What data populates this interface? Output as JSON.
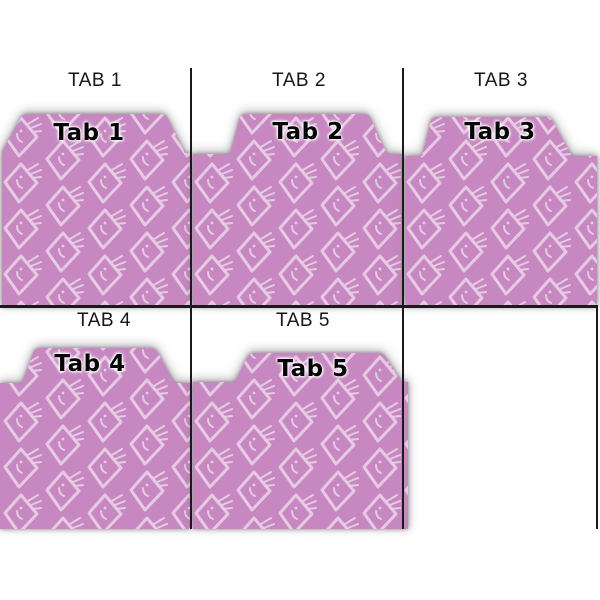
{
  "preview_title": "Tab divider preview sheet",
  "sections": [
    {
      "label": "TAB 1",
      "tab_text": "Tab 1",
      "tab_cut_position": "left"
    },
    {
      "label": "TAB 2",
      "tab_text": "Tab 2",
      "tab_cut_position": "center"
    },
    {
      "label": "TAB 3",
      "tab_text": "Tab 3",
      "tab_cut_position": "left-of-center"
    },
    {
      "label": "TAB 4",
      "tab_text": "Tab 4",
      "tab_cut_position": "center"
    },
    {
      "label": "TAB 5",
      "tab_text": "Tab 5",
      "tab_cut_position": "right-of-center"
    }
  ],
  "colors": {
    "folder_base": "#c788c2",
    "pattern_motif": "#e8cde4",
    "grid_line": "#1a1a1a",
    "label_text": "#161616",
    "tab_text": "#050505"
  }
}
